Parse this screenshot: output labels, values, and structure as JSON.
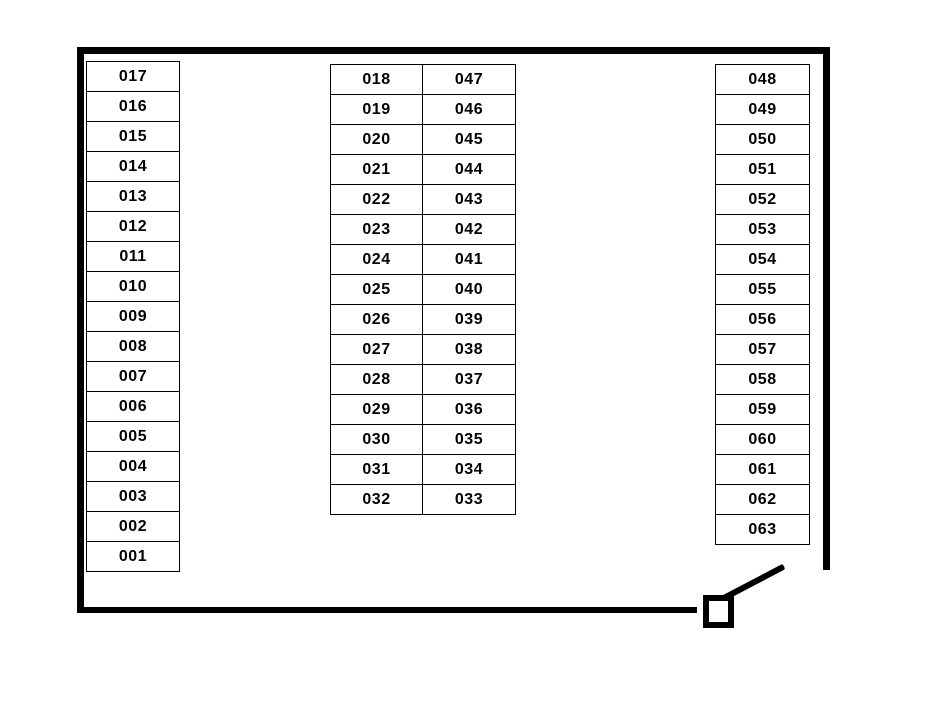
{
  "diagram": {
    "background_color": "#ffffff",
    "wall_color": "#000000",
    "seat_border_color": "#000000",
    "seat_text_color": "#000000",
    "icons": {
      "door": "open-door-with-swing-icon"
    }
  },
  "seats": {
    "left_column": [
      "017",
      "016",
      "015",
      "014",
      "013",
      "012",
      "011",
      "010",
      "009",
      "008",
      "007",
      "006",
      "005",
      "004",
      "003",
      "002",
      "001"
    ],
    "middle_left_column": [
      "018",
      "019",
      "020",
      "021",
      "022",
      "023",
      "024",
      "025",
      "026",
      "027",
      "028",
      "029",
      "030",
      "031",
      "032"
    ],
    "middle_right_column": [
      "047",
      "046",
      "045",
      "044",
      "043",
      "042",
      "041",
      "040",
      "039",
      "038",
      "037",
      "036",
      "035",
      "034",
      "033"
    ],
    "right_column": [
      "048",
      "049",
      "050",
      "051",
      "052",
      "053",
      "054",
      "055",
      "056",
      "057",
      "058",
      "059",
      "060",
      "061",
      "062",
      "063"
    ]
  }
}
